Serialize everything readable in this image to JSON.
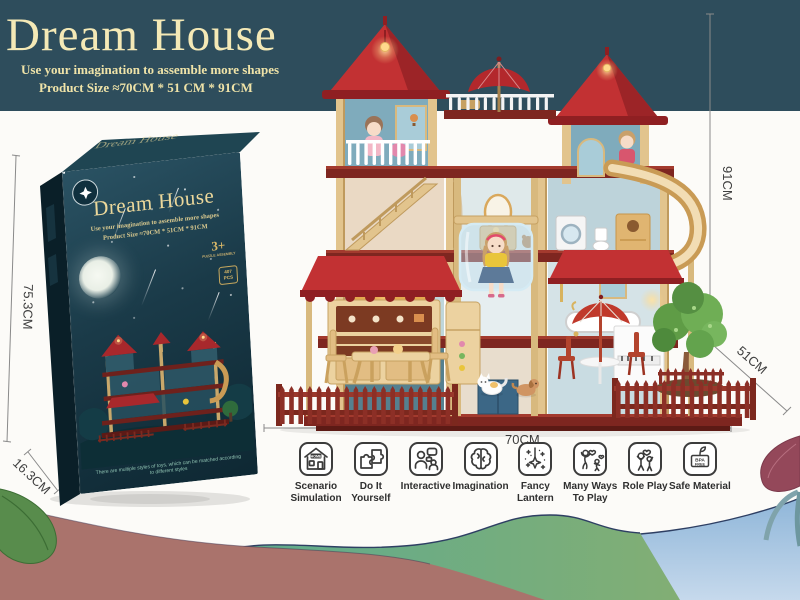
{
  "banner": {
    "title": "Dream House",
    "subtitle": "Use your imagination to assemble more shapes",
    "product_size": "Product Size ≈70CM * 51 CM * 91CM"
  },
  "dimensions": {
    "house_height": "91CM",
    "house_depth": "51CM",
    "house_width": "70CM",
    "box_height": "75.3CM",
    "box_depth": "16.3CM",
    "box_width": "44.3CM"
  },
  "box": {
    "title": "Dream House",
    "subtitle": "Use your imagination to assemble more shapes",
    "product_size": "Product Size ≈70CM * 51CM * 91CM",
    "age_badge": "3+",
    "age_note": "PUZZLE ASSEMBLY",
    "pieces_badge": "407 PCS",
    "bottom_note": "There are multiple styles of toys, which can be matched according to different styles"
  },
  "features": [
    {
      "icon": "scenario-simulation-icon",
      "label": "Scenario\nSimulation",
      "badge": "HOME"
    },
    {
      "icon": "diy-icon",
      "label": "Do It\nYourself"
    },
    {
      "icon": "interactive-icon",
      "label": "Interactive"
    },
    {
      "icon": "imagination-icon",
      "label": "Imagination"
    },
    {
      "icon": "fancy-lantern-icon",
      "label": "Fancy\nLantern"
    },
    {
      "icon": "many-ways-icon",
      "label": "Many Ways\nTo Play"
    },
    {
      "icon": "role-play-icon",
      "label": "Role Play"
    },
    {
      "icon": "safe-material-icon",
      "label": "Safe Material",
      "badge_lines": [
        "BPA",
        "FREE"
      ]
    }
  ],
  "colors": {
    "banner_bg": "#2e4d5c",
    "banner_text": "#f4e9b6",
    "roof_red": "#c23133",
    "floor_maroon": "#7e2620",
    "pillar_tan": "#e2c48d",
    "fence_maroon": "#8c2f26",
    "wave_rose": "#aa736c",
    "wave_teal": "#5cab90",
    "wave_blue": "#8fb6d9",
    "box_bg": "#16333f"
  }
}
